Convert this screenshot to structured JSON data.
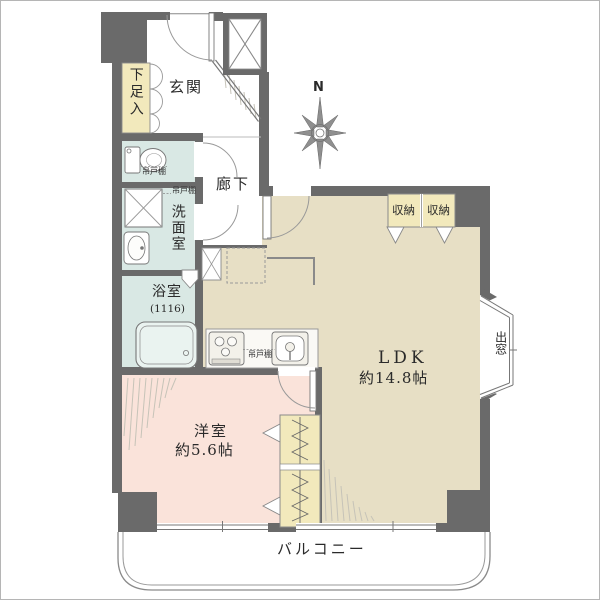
{
  "plan": {
    "compass": "N",
    "rooms": {
      "entrance": "玄関",
      "shoe_box": "下足入",
      "hallway": "廊下",
      "washroom": "洗面室",
      "bathroom": "浴室",
      "bathroom_size": "(1116)",
      "western_room": "洋室",
      "western_room_size": "約5.6帖",
      "ldk": "LDK",
      "ldk_size": "約14.8帖",
      "bay_window": "出窓",
      "balcony": "バルコニー"
    },
    "storage": [
      {
        "label": "収納"
      },
      {
        "label": "収納"
      }
    ],
    "hanging_cabinet": "吊戸棚",
    "colors": {
      "wall": "#6a6a6a",
      "ldk_floor": "#e7dfc5",
      "bedroom_floor": "#fae3da",
      "wet_area_floor": "#d9e8e4",
      "storage_fill": "#f2e9bc",
      "balcony_fill": "#ffffff"
    }
  }
}
